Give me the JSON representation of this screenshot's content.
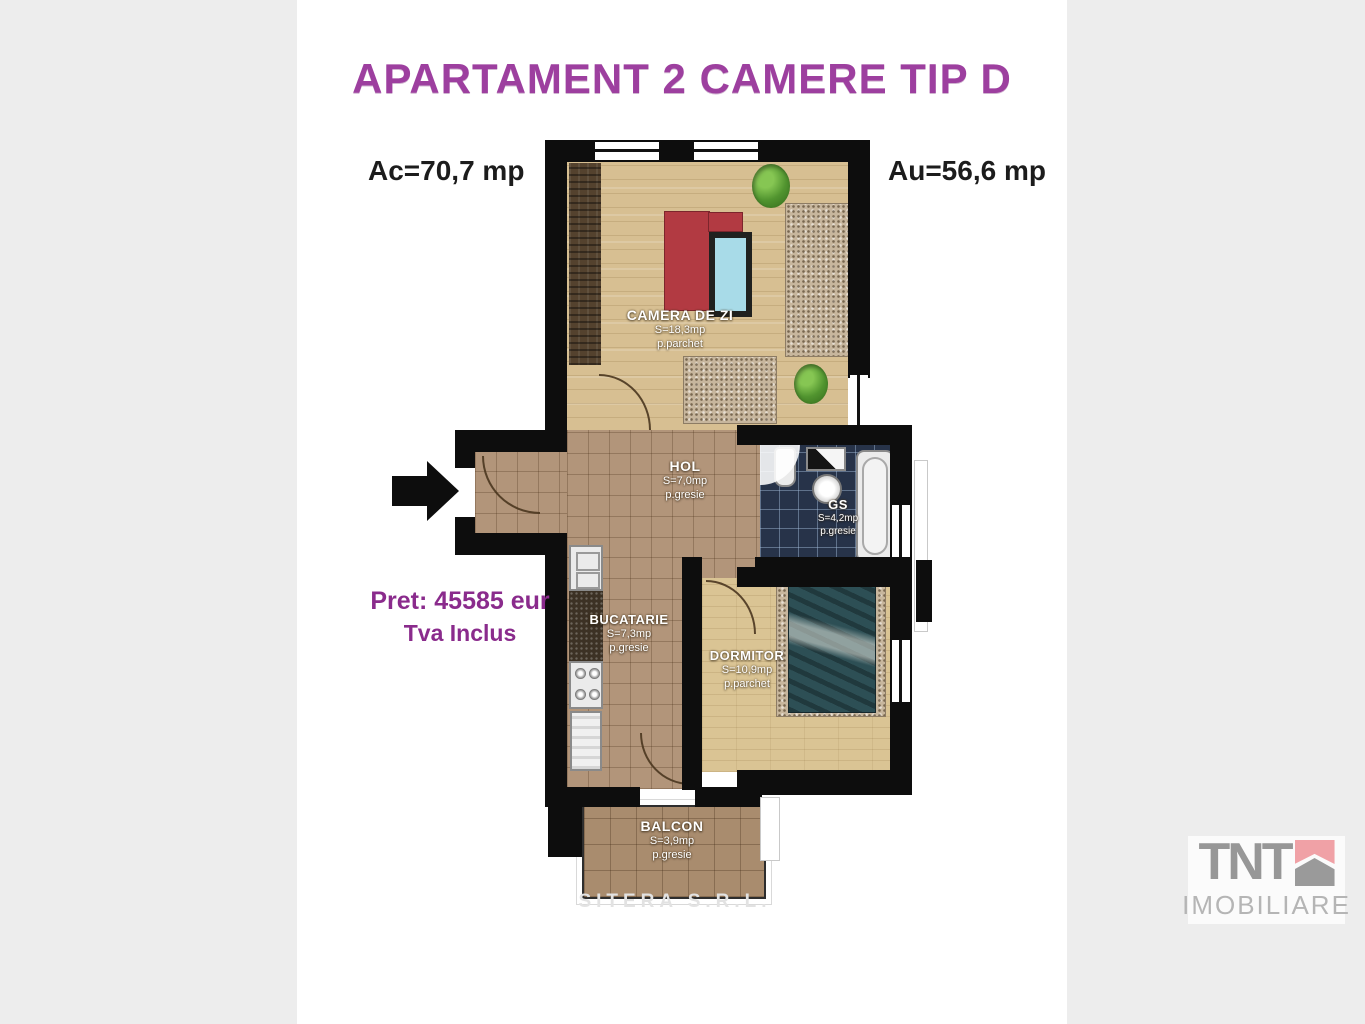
{
  "header": {
    "title": "APARTAMENT 2 CAMERE TIP D",
    "built_area": "Ac=70,7 mp",
    "usable_area": "Au=56,6 mp"
  },
  "price": {
    "line1": "Pret: 45585 eur",
    "line2": "Tva Inclus"
  },
  "rooms": {
    "living": {
      "name": "CAMERA DE ZI",
      "area": "S=18,3mp",
      "floor": "p.parchet"
    },
    "hall": {
      "name": "HOL",
      "area": "S=7,0mp",
      "floor": "p.gresie"
    },
    "bath": {
      "name": "GS",
      "area": "S=4,2mp",
      "floor": "p.gresie"
    },
    "kitchen": {
      "name": "BUCATARIE",
      "area": "S=7,3mp",
      "floor": "p.gresie"
    },
    "bedroom": {
      "name": "DORMITOR",
      "area": "S=10,9mp",
      "floor": "p.parchet"
    },
    "balcony": {
      "name": "BALCON",
      "area": "S=3,9mp",
      "floor": "p.gresie"
    }
  },
  "watermark": "SITERA S.R.L.",
  "logo": {
    "brand": "TNT",
    "subtitle": "IMOBILIARE"
  },
  "icons": {
    "entrance_arrow": "right-arrow",
    "logo_mark": "house-with-ribbon"
  },
  "colors": {
    "background_side": "#ededed",
    "panel": "#ffffff",
    "title_purple": "#9d3f9f",
    "price_purple": "#8a2b8c",
    "wall_black": "#0d0d0d",
    "wood_floor": "#d7bf92",
    "tile_floor": "#b2957a",
    "bath_tile": "#273349",
    "sofa_red": "#b23a42",
    "table_blue": "#a8dbe8",
    "bed_teal": "#2d4f55",
    "logo_gray": "#979797",
    "logo_pink": "#f0a1a6"
  }
}
